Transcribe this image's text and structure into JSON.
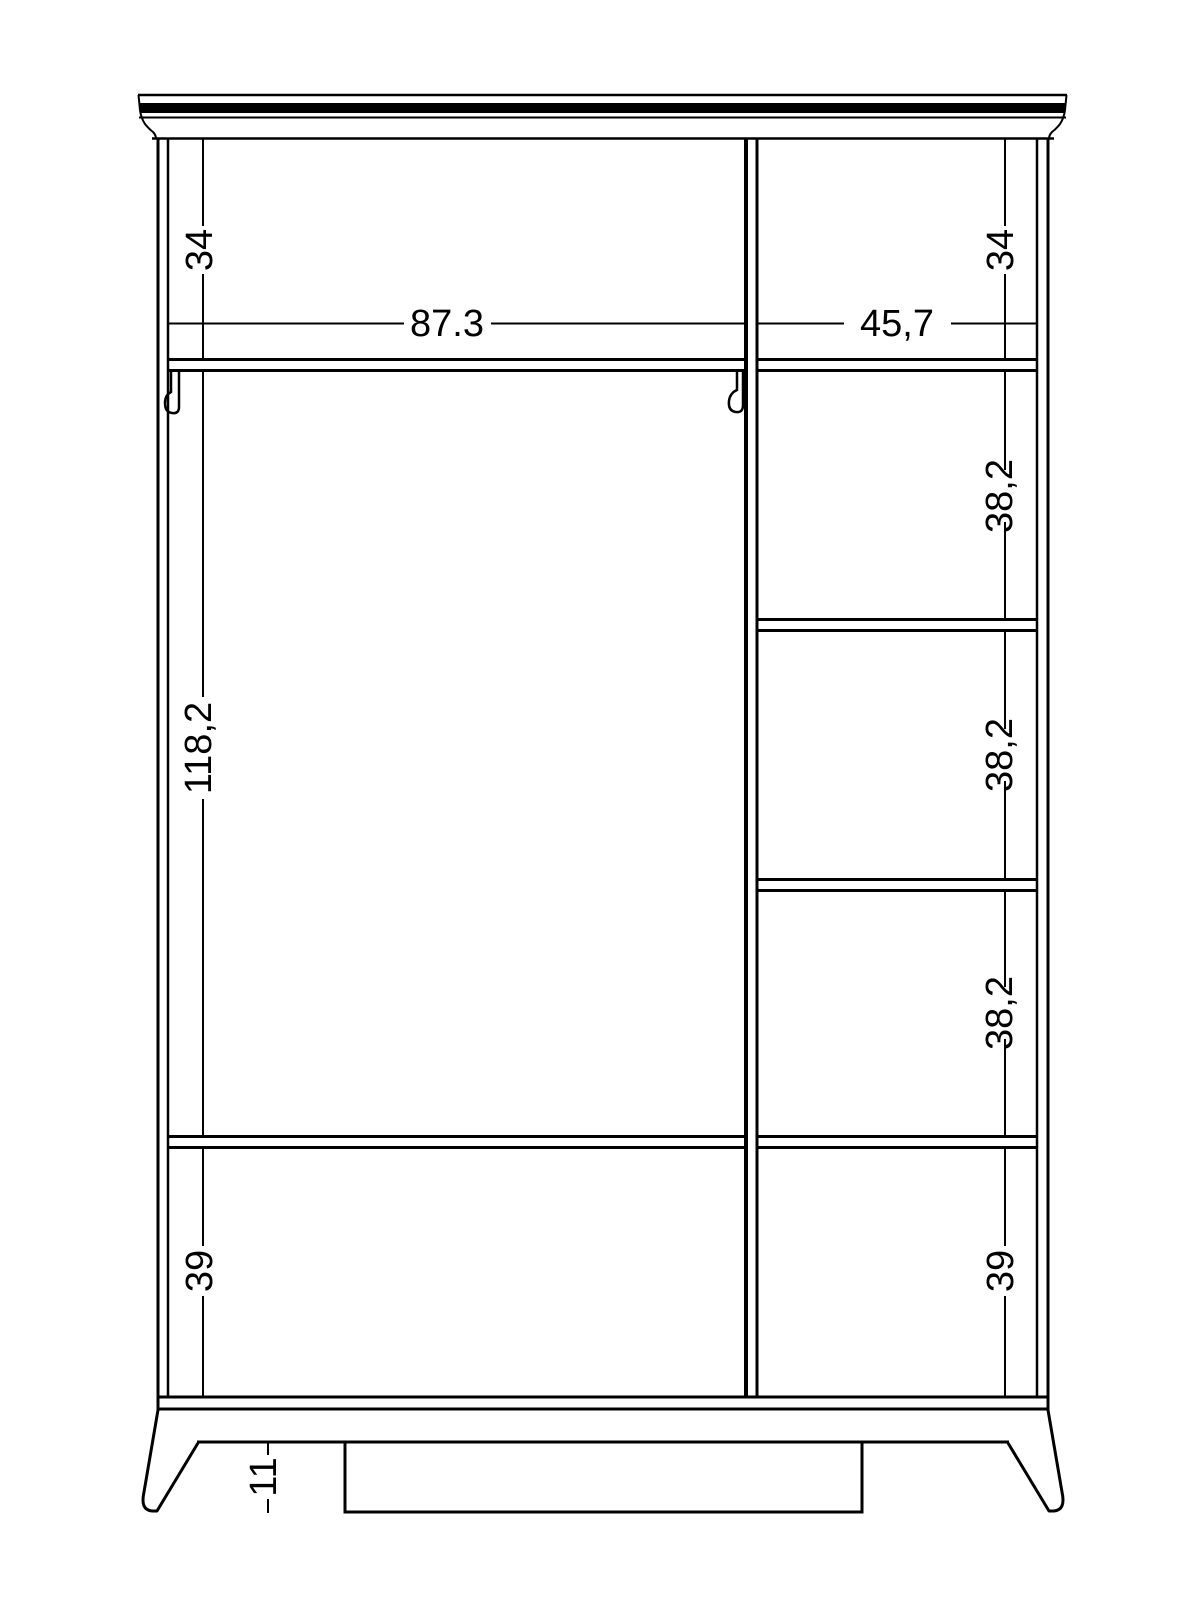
{
  "document": {
    "type": "wardrobe front-view technical drawing",
    "background_color": "#ffffff",
    "line_color": "#000000"
  },
  "dimensions": {
    "top_left_gap": "34",
    "top_right_gap": "34",
    "left_compartment_width": "87.3",
    "right_compartment_width": "45,7",
    "left_compartment_height": "118,2",
    "right_shelf_gap_1": "38,2",
    "right_shelf_gap_2": "38,2",
    "right_shelf_gap_3": "38,2",
    "bottom_left_gap": "39",
    "bottom_right_gap": "39",
    "foot_height": "11"
  }
}
